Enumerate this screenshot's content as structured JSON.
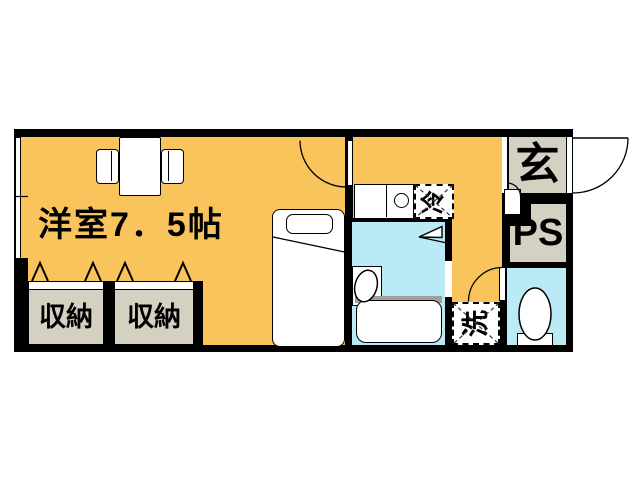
{
  "rooms": {
    "main": {
      "label": "洋室7．5帖"
    },
    "closet_left": {
      "label": "収納"
    },
    "closet_right": {
      "label": "収納"
    },
    "entrance": {
      "label": "玄"
    },
    "pipe_space": {
      "label": "PS"
    }
  },
  "appliances": {
    "refrigerator": {
      "label": "冷"
    },
    "washing_machine": {
      "label": "洗"
    }
  },
  "colors": {
    "room_floor_orange": "#F9C45C",
    "wet_area_cyan": "#B9EAF6",
    "service_beige": "#D4D0C2",
    "wall_black": "#000000",
    "tub_deck_gray": "#A0A0A0",
    "background_white": "#FFFFFF"
  }
}
